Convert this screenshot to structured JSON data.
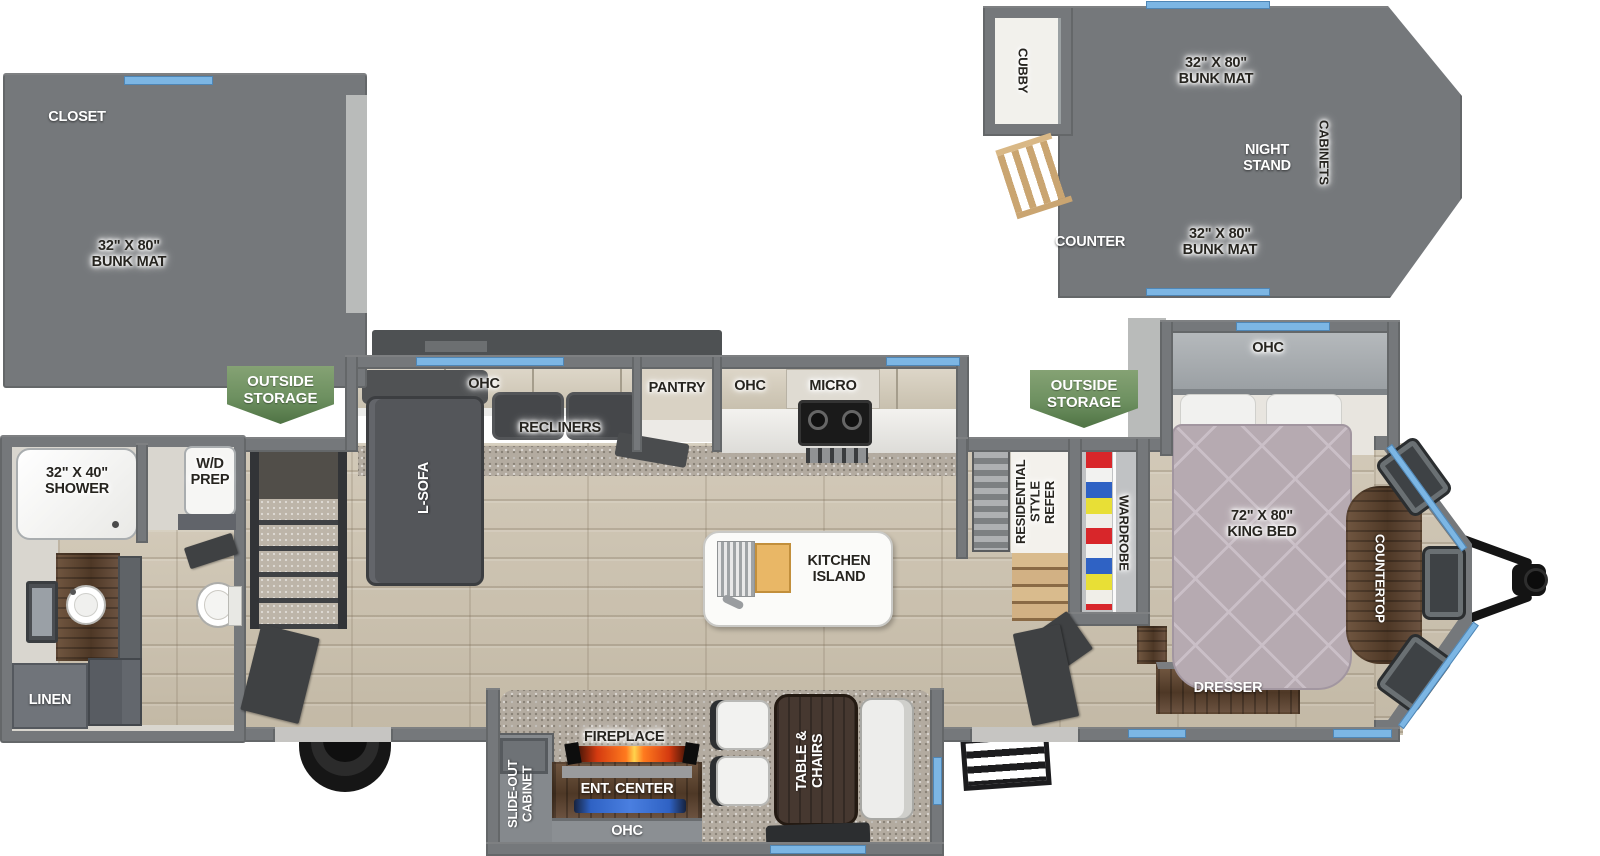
{
  "colors": {
    "wall_gray": "#75787b",
    "window_blue": "#7cb6e4",
    "badge_green": "#6d9060",
    "wood_floor": "#cdc4b2",
    "dark_wood": "#5d4532",
    "bed": "#b6aab1",
    "flame_orange": "#ff7a1e",
    "tv_blue": "#4a7fe0"
  },
  "badges": {
    "outside_storage": "OUTSIDE\nSTORAGE"
  },
  "loft_left": {
    "closet": "CLOSET",
    "bunk": "32\" X 80\"\nBUNK MAT"
  },
  "loft_right": {
    "cubby": "CUBBY",
    "bunk_top": "32\" X 80\"\nBUNK MAT",
    "night_stand": "NIGHT\nSTAND",
    "cabinets": "CABINETS",
    "counter": "COUNTER",
    "bunk_bottom": "32\" X 80\"\nBUNK MAT"
  },
  "living": {
    "ohc": "OHC",
    "recliners": "RECLINERS",
    "l_sofa": "L-SOFA",
    "pantry": "PANTRY"
  },
  "kitchen": {
    "ohc": "OHC",
    "micro": "MICRO",
    "island": "KITCHEN\nISLAND",
    "refer": "RESIDENTIAL\nSTYLE\nREFER"
  },
  "bedroom": {
    "ohc": "OHC",
    "wardrobe": "WARDROBE",
    "king_bed": "72\" X 80\"\nKING BED",
    "countertop": "COUNTERTOP",
    "dresser": "DRESSER"
  },
  "bathroom": {
    "shower": "32\" X 40\"\nSHOWER",
    "wd_prep": "W/D\nPREP",
    "linen": "LINEN"
  },
  "dinette": {
    "cabinet": "SLIDE-OUT\nCABINET",
    "fireplace": "FIREPLACE",
    "ent_center": "ENT. CENTER",
    "ohc": "OHC",
    "table": "TABLE &\nCHAIRS"
  }
}
